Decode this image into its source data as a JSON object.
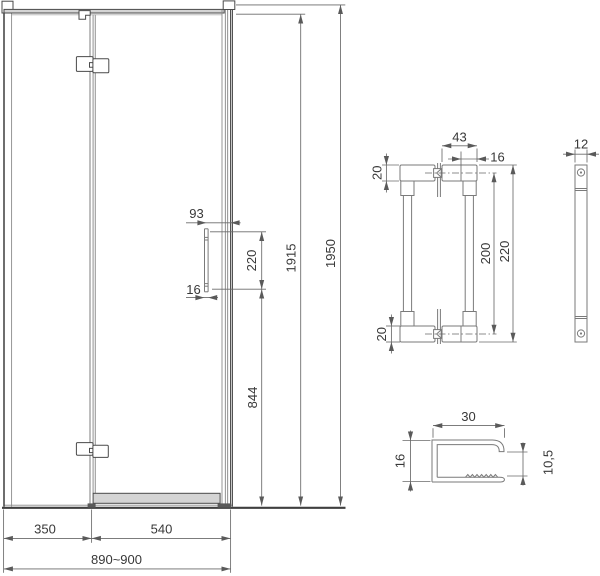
{
  "drawing": {
    "type": "shower-door technical dimension drawing",
    "colors": {
      "structure_line": "#4a4a4a",
      "glass_line": "#9a9a9a",
      "dimension_line": "#6a6a6a",
      "profile_fill": "#d4d4d4",
      "text": "#383838"
    },
    "views": {
      "door_front": {
        "dims": {
          "handle_to_edge": "93",
          "handle_length": "220",
          "handle_diameter": "16",
          "glass_height": "1915",
          "total_height": "1950",
          "handle_bottom_height": "844",
          "fixed_panel_width": "350",
          "door_width": "540",
          "total_width": "890~900"
        }
      },
      "handle_front": {
        "dims": {
          "block_length": "43",
          "hole_to_end": "16",
          "top_block_height": "20",
          "bottom_block_height": "20",
          "hole_spacing": "200",
          "overall_length": "220"
        }
      },
      "handle_side": {
        "dims": {
          "thickness": "12"
        }
      },
      "bottom_profile": {
        "dims": {
          "width": "30",
          "height": "16",
          "channel_opening": "10,5"
        }
      }
    }
  }
}
